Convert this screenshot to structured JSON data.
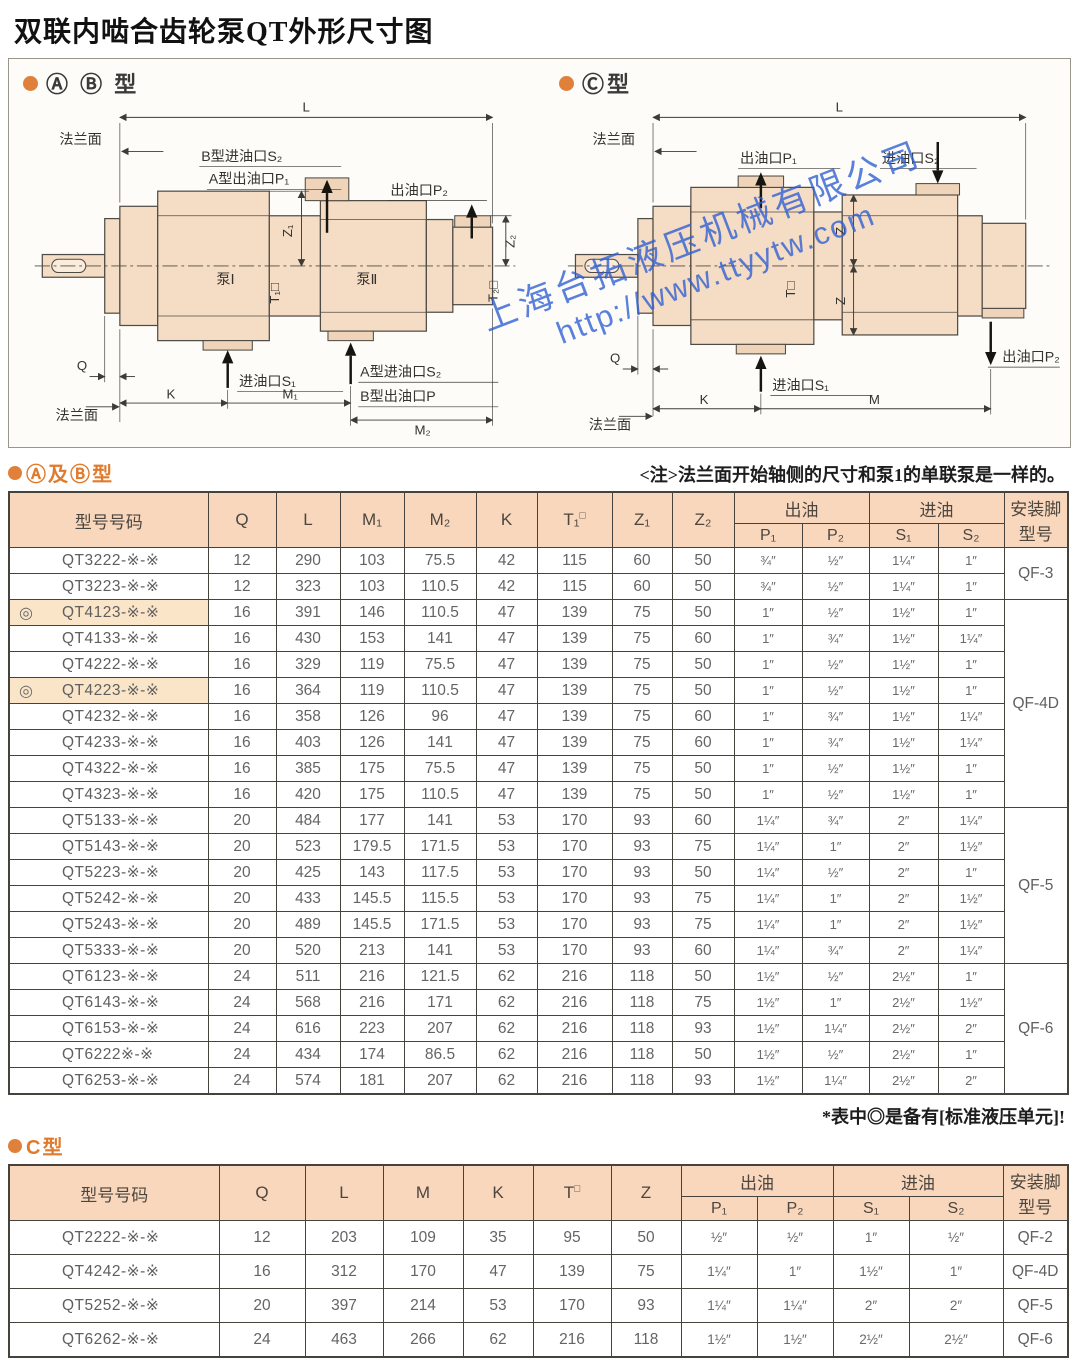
{
  "page": {
    "title": "双联内啮合齿轮泵QT外形尺寸图"
  },
  "diagram": {
    "ab": {
      "section_title": "Ⓐ Ⓑ 型",
      "dim_l": "L",
      "flange_top": "法兰面",
      "port_b_in": "B型进油口S₂",
      "port_a_out": "A型出油口P₁",
      "port_p2": "出油口P₂",
      "z1": "Z₁",
      "z2": "Z₂",
      "t1": "T₁□",
      "t2": "T₂□",
      "pump1": "泵Ⅰ",
      "pump2": "泵Ⅱ",
      "q": "Q",
      "k": "K",
      "m1": "M₁",
      "m2": "M₂",
      "port_s1": "进油口S₁",
      "port_a_in": "A型进油口S₂",
      "port_b_out": "B型出油口P",
      "flange_bottom": "法兰面"
    },
    "c": {
      "section_title": "Ⓒ型",
      "dim_l": "L",
      "flange_top": "法兰面",
      "port_p1": "出油口P₁",
      "port_s2": "进油口S₂",
      "z_upper": "Z",
      "z_lower": "Z",
      "t": "T□",
      "q": "Q",
      "k": "K",
      "m": "M",
      "port_s1": "进油口S₁",
      "port_p2": "出油口P₂",
      "flange_bottom": "法兰面"
    },
    "watermark": {
      "line1": "上海台拓液压机械有限公司",
      "line2": "http://www.ttyytw.com"
    }
  },
  "section_ab": {
    "title": "Ⓐ及Ⓑ型",
    "note": "<注>法兰面开始轴侧的尺寸和泵1的单联泵是一样的。"
  },
  "section_c": {
    "title": "C型"
  },
  "footnote": "*表中◎是备有[标准液压单元]!",
  "table_ab": {
    "headers": {
      "model": "型号号码",
      "q": "Q",
      "l": "L",
      "m1": "M₁",
      "m2": "M₂",
      "k": "K",
      "t_base": "T₁",
      "t_sup": "□",
      "z1": "Z₁",
      "z2": "Z₂",
      "out": "出油",
      "in": "进油",
      "p1": "P₁",
      "p2": "P₂",
      "s1": "S₁",
      "s2": "S₂",
      "foot1": "安装脚",
      "foot2": "型号"
    },
    "rows": [
      {
        "model": "QT3222-※-※",
        "vals": [
          "12",
          "290",
          "103",
          "75.5",
          "42",
          "115",
          "60",
          "50",
          "¾″",
          "½″",
          "1¼″",
          "1″"
        ],
        "foot": "QF-3",
        "foot_span": 2
      },
      {
        "model": "QT3223-※-※",
        "vals": [
          "12",
          "323",
          "103",
          "110.5",
          "42",
          "115",
          "60",
          "50",
          "¾″",
          "½″",
          "1¼″",
          "1″"
        ]
      },
      {
        "mark": "◎",
        "hl": true,
        "model": "QT4123-※-※",
        "vals": [
          "16",
          "391",
          "146",
          "110.5",
          "47",
          "139",
          "75",
          "50",
          "1″",
          "½″",
          "1½″",
          "1″"
        ],
        "foot": "QF-4D",
        "foot_span": 8
      },
      {
        "model": "QT4133-※-※",
        "vals": [
          "16",
          "430",
          "153",
          "141",
          "47",
          "139",
          "75",
          "60",
          "1″",
          "¾″",
          "1½″",
          "1¼″"
        ]
      },
      {
        "model": "QT4222-※-※",
        "vals": [
          "16",
          "329",
          "119",
          "75.5",
          "47",
          "139",
          "75",
          "50",
          "1″",
          "½″",
          "1½″",
          "1″"
        ]
      },
      {
        "mark": "◎",
        "hl": true,
        "model": "QT4223-※-※",
        "vals": [
          "16",
          "364",
          "119",
          "110.5",
          "47",
          "139",
          "75",
          "50",
          "1″",
          "½″",
          "1½″",
          "1″"
        ]
      },
      {
        "model": "QT4232-※-※",
        "vals": [
          "16",
          "358",
          "126",
          "96",
          "47",
          "139",
          "75",
          "60",
          "1″",
          "¾″",
          "1½″",
          "1¼″"
        ]
      },
      {
        "model": "QT4233-※-※",
        "vals": [
          "16",
          "403",
          "126",
          "141",
          "47",
          "139",
          "75",
          "60",
          "1″",
          "¾″",
          "1½″",
          "1¼″"
        ]
      },
      {
        "model": "QT4322-※-※",
        "vals": [
          "16",
          "385",
          "175",
          "75.5",
          "47",
          "139",
          "75",
          "50",
          "1″",
          "½″",
          "1½″",
          "1″"
        ]
      },
      {
        "model": "QT4323-※-※",
        "vals": [
          "16",
          "420",
          "175",
          "110.5",
          "47",
          "139",
          "75",
          "50",
          "1″",
          "½″",
          "1½″",
          "1″"
        ]
      },
      {
        "model": "QT5133-※-※",
        "vals": [
          "20",
          "484",
          "177",
          "141",
          "53",
          "170",
          "93",
          "60",
          "1¼″",
          "¾″",
          "2″",
          "1¼″"
        ],
        "foot": "QF-5",
        "foot_span": 6
      },
      {
        "model": "QT5143-※-※",
        "vals": [
          "20",
          "523",
          "179.5",
          "171.5",
          "53",
          "170",
          "93",
          "75",
          "1¼″",
          "1″",
          "2″",
          "1½″"
        ]
      },
      {
        "model": "QT5223-※-※",
        "vals": [
          "20",
          "425",
          "143",
          "117.5",
          "53",
          "170",
          "93",
          "50",
          "1¼″",
          "½″",
          "2″",
          "1″"
        ]
      },
      {
        "model": "QT5242-※-※",
        "vals": [
          "20",
          "433",
          "145.5",
          "115.5",
          "53",
          "170",
          "93",
          "75",
          "1¼″",
          "1″",
          "2″",
          "1½″"
        ]
      },
      {
        "model": "QT5243-※-※",
        "vals": [
          "20",
          "489",
          "145.5",
          "171.5",
          "53",
          "170",
          "93",
          "75",
          "1¼″",
          "1″",
          "2″",
          "1½″"
        ]
      },
      {
        "model": "QT5333-※-※",
        "vals": [
          "20",
          "520",
          "213",
          "141",
          "53",
          "170",
          "93",
          "60",
          "1¼″",
          "¾″",
          "2″",
          "1¼″"
        ]
      },
      {
        "model": "QT6123-※-※",
        "vals": [
          "24",
          "511",
          "216",
          "121.5",
          "62",
          "216",
          "118",
          "50",
          "1½″",
          "½″",
          "2½″",
          "1″"
        ],
        "foot": "QF-6",
        "foot_span": 5
      },
      {
        "model": "QT6143-※-※",
        "vals": [
          "24",
          "568",
          "216",
          "171",
          "62",
          "216",
          "118",
          "75",
          "1½″",
          "1″",
          "2½″",
          "1½″"
        ]
      },
      {
        "model": "QT6153-※-※",
        "vals": [
          "24",
          "616",
          "223",
          "207",
          "62",
          "216",
          "118",
          "93",
          "1½″",
          "1¼″",
          "2½″",
          "2″"
        ]
      },
      {
        "model": "QT6222※-※",
        "vals": [
          "24",
          "434",
          "174",
          "86.5",
          "62",
          "216",
          "118",
          "50",
          "1½″",
          "½″",
          "2½″",
          "1″"
        ]
      },
      {
        "model": "QT6253-※-※",
        "vals": [
          "24",
          "574",
          "181",
          "207",
          "62",
          "216",
          "118",
          "93",
          "1½″",
          "1¼″",
          "2½″",
          "2″"
        ]
      }
    ]
  },
  "table_c": {
    "headers": {
      "model": "型号号码",
      "q": "Q",
      "l": "L",
      "m": "M",
      "k": "K",
      "t_base": "T",
      "t_sup": "□",
      "z": "Z",
      "out": "出油",
      "in": "进油",
      "p1": "P₁",
      "p2": "P₂",
      "s1": "S₁",
      "s2": "S₂",
      "foot1": "安装脚",
      "foot2": "型号"
    },
    "rows": [
      {
        "model": "QT2222-※-※",
        "vals": [
          "12",
          "203",
          "109",
          "35",
          "95",
          "50",
          "½″",
          "½″",
          "1″",
          "½″"
        ],
        "foot": "QF-2",
        "foot_span": 1
      },
      {
        "model": "QT4242-※-※",
        "vals": [
          "16",
          "312",
          "170",
          "47",
          "139",
          "75",
          "1¼″",
          "1″",
          "1½″",
          "1″"
        ],
        "foot": "QF-4D",
        "foot_span": 1
      },
      {
        "model": "QT5252-※-※",
        "vals": [
          "20",
          "397",
          "214",
          "53",
          "170",
          "93",
          "1¼″",
          "1¼″",
          "2″",
          "2″"
        ],
        "foot": "QF-5",
        "foot_span": 1
      },
      {
        "model": "QT6262-※-※",
        "vals": [
          "24",
          "463",
          "266",
          "62",
          "216",
          "118",
          "1½″",
          "1½″",
          "2½″",
          "2½″"
        ],
        "foot": "QF-6",
        "foot_span": 1
      }
    ]
  }
}
